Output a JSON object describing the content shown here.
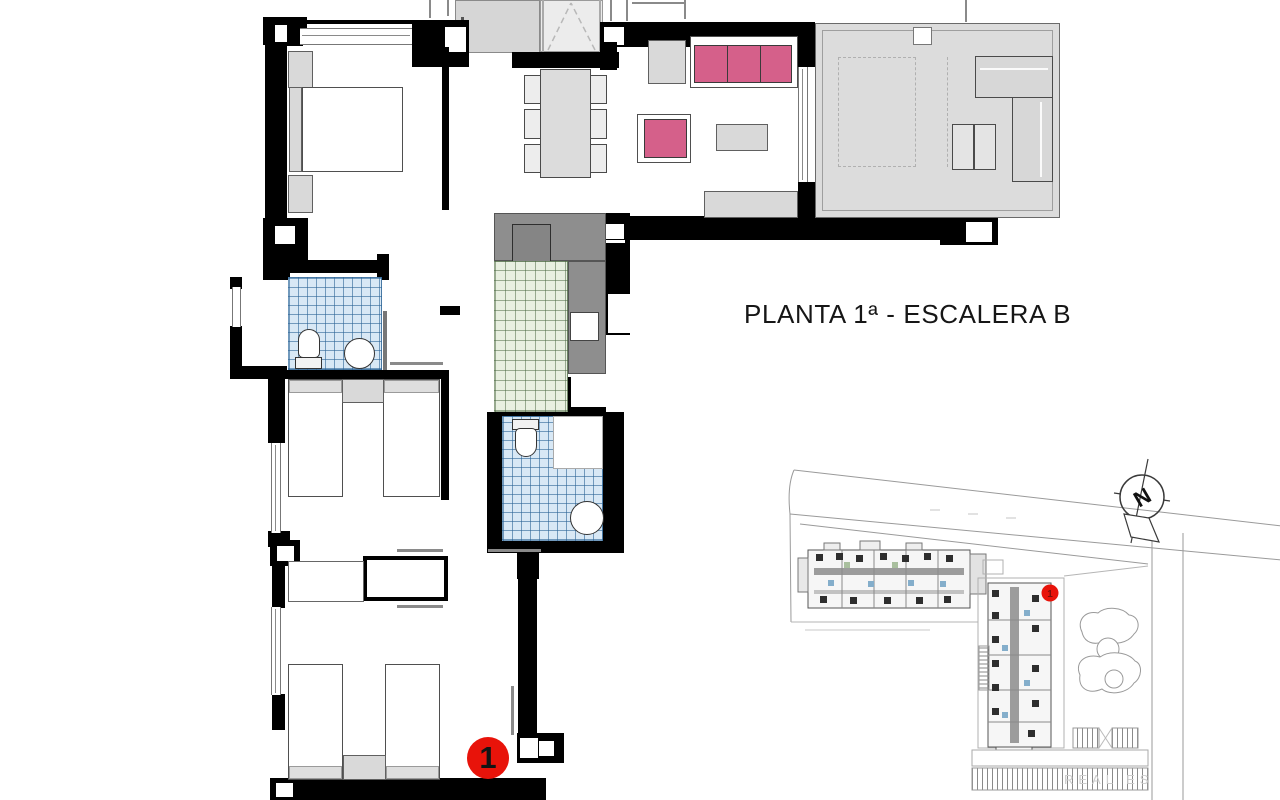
{
  "title": {
    "text": "PLANTA 1ª - ESCALERA B"
  },
  "floor_plan": {
    "unit_marker_label": "1"
  },
  "site_plan": {
    "marker_label": "1",
    "watermark": "REAL ES",
    "north_label": "N"
  },
  "colors": {
    "wall_black": "#000000",
    "marker_red": "#e8130a",
    "sofa_pink": "#d5608a",
    "bath_tile_blue": "#d8e8f5",
    "kitchen_tile_green": "#e8efe0",
    "counter_gray": "#8e8e8e",
    "terrace_gray": "#dcdcdc",
    "furniture_gray": "#d9d9d9"
  }
}
